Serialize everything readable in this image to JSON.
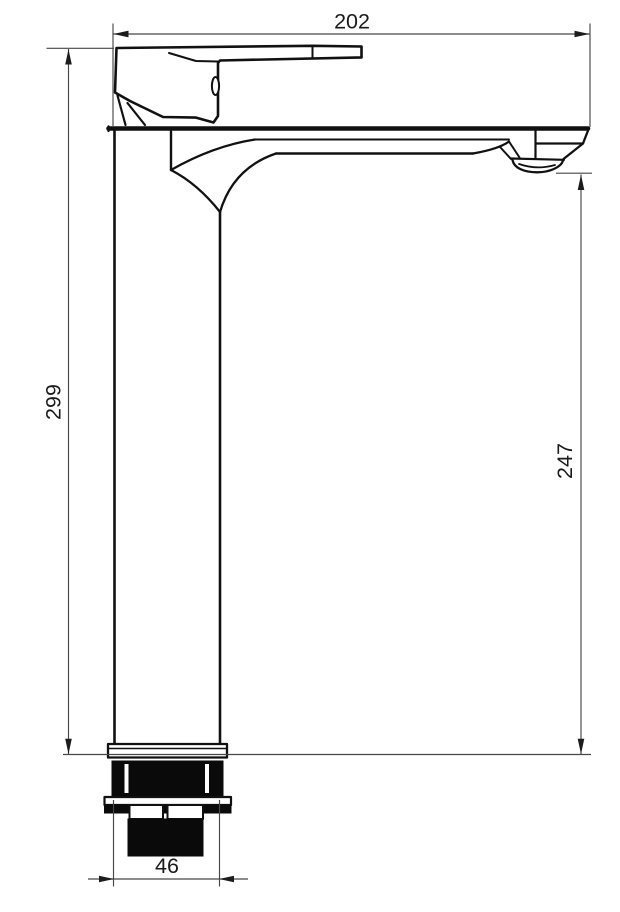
{
  "drawing": {
    "subject": "tall-basin-mixer-faucet-side-view",
    "dims": {
      "top_width": {
        "value": "202"
      },
      "left_height": {
        "value": "299"
      },
      "right_height": {
        "value": "247"
      },
      "bottom_width": {
        "value": "46"
      }
    },
    "colors": {
      "outline": "#111111",
      "dimension_lines": "#474747",
      "text": "#1a1a1a",
      "solid_fill": "#0a0a0a",
      "background": "#ffffff"
    }
  }
}
